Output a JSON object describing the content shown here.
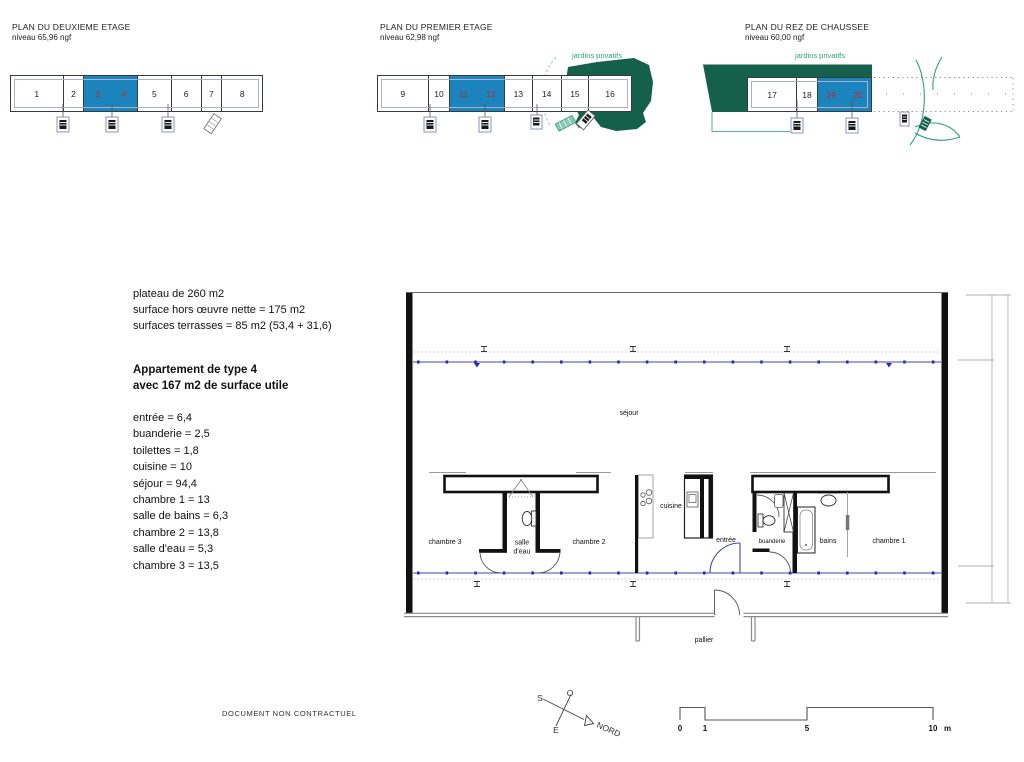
{
  "plans": [
    {
      "title": "PLAN DU DEUXIEME ETAGE",
      "level": "niveau 65,96 ngf",
      "units": [
        "1",
        "2",
        "3",
        "4",
        "5",
        "6",
        "7",
        "8"
      ],
      "highlighted_units": [
        "3",
        "4"
      ]
    },
    {
      "title": "PLAN DU PREMIER ETAGE",
      "level": "niveau 62,98 ngf",
      "garden_label": "jardins privatifs",
      "units": [
        "9",
        "10",
        "11",
        "12",
        "13",
        "14",
        "15",
        "16"
      ],
      "highlighted_units": [
        "11",
        "12"
      ]
    },
    {
      "title": "PLAN DU REZ DE CHAUSSEE",
      "level": "niveau 60,00 ngf",
      "garden_label": "jardins privatifs",
      "units": [
        "17",
        "18",
        "19",
        "20"
      ],
      "highlighted_units": [
        "19",
        "20"
      ]
    }
  ],
  "summary": {
    "lines": [
      "plateau de 260 m2",
      "surface hors œuvre nette = 175 m2",
      "surfaces terrasses = 85 m2 (53,4 + 31,6)"
    ]
  },
  "apartment": {
    "title_line1": "Appartement de type 4",
    "title_line2": "avec 167 m2 de surface utile",
    "rooms": [
      "entrée = 6,4",
      "buanderie = 2,5",
      "toilettes = 1,8",
      "cuisine = 10",
      "séjour = 94,4",
      "chambre 1 = 13",
      "salle de bains = 6,3",
      "chambre 2 = 13,8",
      "salle d'eau = 5,3",
      "chambre 3 = 13,5"
    ]
  },
  "floorplan": {
    "labels": {
      "sejour": "séjour",
      "chambre3": "chambre 3",
      "salle_deau_1": "salle",
      "salle_deau_2": "d'eau",
      "chambre2": "chambre 2",
      "cuisine": "cuisine",
      "entree": "entrée",
      "buanderie": "buanderie",
      "bains": "bains",
      "chambre1": "chambre 1",
      "pallier": "pallier"
    }
  },
  "compass": {
    "o": "O",
    "s": "S",
    "e": "E",
    "nord": "NORD"
  },
  "scalebar": {
    "ticks": [
      "0",
      "1",
      "5",
      "10"
    ],
    "unit": "m"
  },
  "footer": {
    "disclaimer": "DOCUMENT NON CONTRACTUEL"
  },
  "colors": {
    "highlight_blue": "#1b84bd",
    "unit_number_red": "#c1272d",
    "garden_dark_green": "#15604a",
    "garden_teal": "#2fa080",
    "glazing_blue": "#4646ae"
  }
}
